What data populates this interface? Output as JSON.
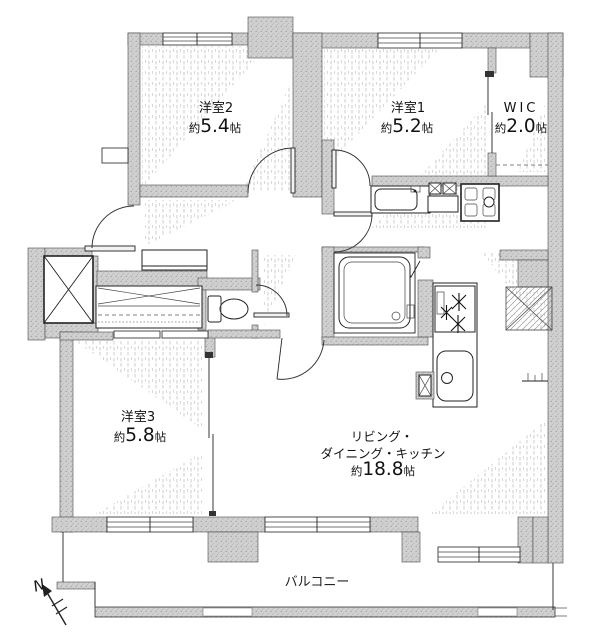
{
  "title": "apartment-floor-plan",
  "rooms": {
    "y2": {
      "name": "洋室2",
      "approx": "約",
      "size": "5.4",
      "unit": "帖"
    },
    "y1": {
      "name": "洋室1",
      "approx": "約",
      "size": "5.2",
      "unit": "帖"
    },
    "wic": {
      "name": "WIC",
      "approx": "約",
      "size": "2.0",
      "unit": "帖"
    },
    "y3": {
      "name": "洋室3",
      "approx": "約",
      "size": "5.8",
      "unit": "帖"
    },
    "ldk": {
      "line1": "リビング・",
      "line2": "ダイニング・キッチン",
      "approx": "約",
      "size": "18.8",
      "unit": "帖"
    }
  },
  "balcony": {
    "label": "バルコニー"
  },
  "compass": {
    "label": "N"
  },
  "colors": {
    "wall_fill": "#cdcdcd",
    "speckle": "#9e9e9e",
    "line": "#222222",
    "background": "#ffffff"
  }
}
